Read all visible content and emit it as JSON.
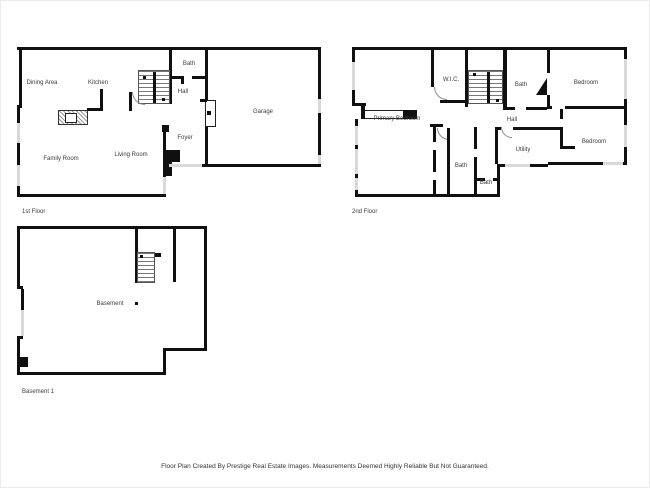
{
  "floors": {
    "first": {
      "caption": "1st Floor",
      "rooms": {
        "dining_area": "Dining Area",
        "kitchen": "Kitchen",
        "bath": "Bath",
        "hall": "Hall",
        "garage": "Garage",
        "foyer": "Foyer",
        "living_room": "Living Room",
        "family_room": "Family Room"
      }
    },
    "second": {
      "caption": "2nd Floor",
      "rooms": {
        "wic": "W.I.C.",
        "bath_top": "Bath",
        "bedroom_top": "Bedroom",
        "primary_bedroom": "Primary Bedroom",
        "hall": "Hall",
        "utility": "Utility",
        "bedroom_right": "Bedroom",
        "bath_main": "Bath",
        "bath_small": "Bath"
      }
    },
    "basement": {
      "caption": "Basement 1",
      "rooms": {
        "basement": "Basement"
      }
    }
  },
  "footer": {
    "disclaimer": "Floor Plan Created By Prestige Real Estate Images. Measurements Deemed Highly Reliable But Not Guaranteed."
  },
  "colors": {
    "wall": "#101010",
    "window": "#d9d9d9",
    "label": "#3c3c3c",
    "text": "#333333"
  }
}
